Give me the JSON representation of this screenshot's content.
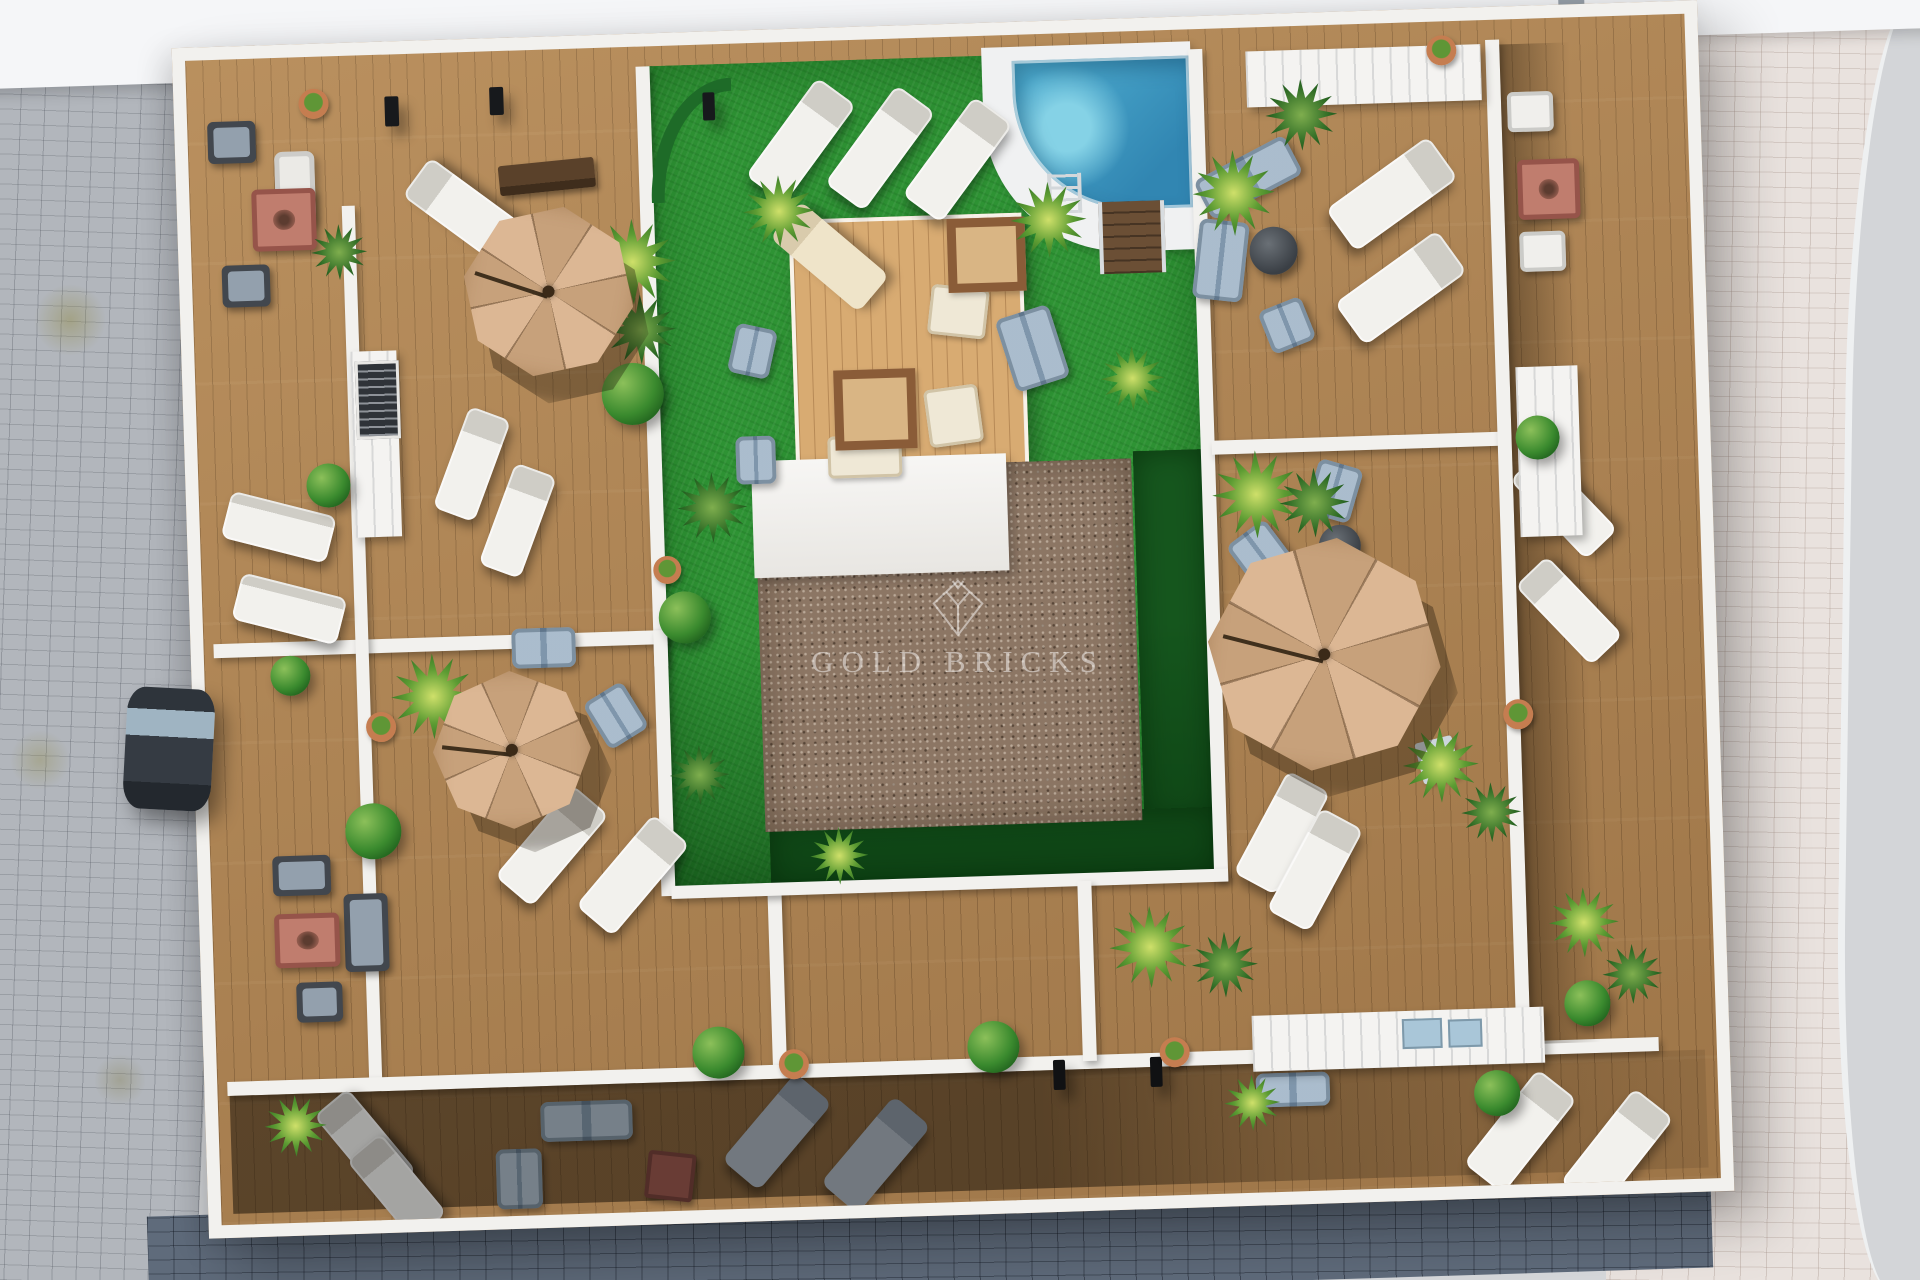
{
  "watermark": {
    "text": "GOLD BRICKS",
    "logo": "gold-bricks-diamond"
  },
  "palette": {
    "wall": "#f2f1ee",
    "wood": "#ae8352",
    "wood-line": "rgba(74,48,22,0.30)",
    "platform": "#d8ab72",
    "grass": "#2e9334",
    "grass-dark": "#16571e",
    "gravel": "#8c7664",
    "pool1": "#52b2d4",
    "pool2": "#3186b2",
    "umb1": "#dcb794",
    "umb2": "#c7a17b",
    "pave-left": "#b2b6bc",
    "pave-right": "#e9e2de",
    "pave-far": "#d3d5d8",
    "pave-bottom": "#5f6b7b",
    "band": "#f5f6f8",
    "wm": "rgba(255,255,255,0.48)"
  },
  "scene": {
    "zones": [
      [
        "courtyard-grass",
        "grass",
        460,
        20,
        545,
        825
      ],
      [
        "grass-shadow-right",
        "grass-dark",
        935,
        420,
        70,
        372
      ],
      [
        "grass-shadow-bottom",
        "grass-dark",
        560,
        778,
        445,
        67
      ],
      [
        "grass-shade",
        "grass-shade",
        460,
        590,
        545,
        255
      ],
      [
        "pool-deck",
        "pool-surround",
        796,
        12,
        209,
        208
      ],
      [
        "swimming-pool",
        "pool",
        826,
        26,
        177,
        152
      ],
      [
        "pool-steps",
        "steps",
        908,
        170,
        58,
        72
      ],
      [
        "wood-platform",
        "platform",
        598,
        178,
        225,
        262
      ],
      [
        "core-roof-gravel",
        "gravel",
        556,
        427,
        377,
        362
      ],
      [
        "core-roof-white",
        "core-white",
        553,
        418,
        255,
        117
      ],
      [
        "dividing-wall",
        "wall",
        450,
        20,
        14,
        600
      ],
      [
        "dividing-wall",
        "wall",
        10,
        584,
        454,
        14
      ],
      [
        "dividing-wall",
        "wall",
        152,
        150,
        13,
        880
      ],
      [
        "dividing-wall",
        "wall",
        450,
        584,
        14,
        266
      ],
      [
        "dividing-wall",
        "wall",
        556,
        845,
        14,
        185
      ],
      [
        "dividing-wall",
        "wall",
        10,
        1022,
        1432,
        14
      ],
      [
        "dividing-wall",
        "wall",
        1003,
        20,
        14,
        832
      ],
      [
        "dividing-wall",
        "wall",
        1014,
        412,
        292,
        14
      ],
      [
        "dividing-wall",
        "wall",
        1300,
        20,
        14,
        1010
      ],
      [
        "dividing-wall",
        "wall",
        460,
        840,
        557,
        13
      ],
      [
        "dividing-wall",
        "wall",
        866,
        848,
        14,
        180
      ],
      [
        "strip-shadow",
        "lshade",
        1314,
        25,
        70,
        1000
      ],
      [
        "lower-terrace-shade",
        "shade",
        12,
        1036,
        1476,
        118
      ]
    ],
    "items": [
      [
        "sun-lounger",
        "uwhite",
        589,
        38,
        48,
        122,
        38
      ],
      [
        "sun-lounger",
        "uwhite",
        668,
        48,
        48,
        122,
        38
      ],
      [
        "sun-lounger",
        "uwhite",
        745,
        62,
        48,
        122,
        38
      ],
      [
        "sun-lounger",
        "uwhite",
        250,
        100,
        48,
        118,
        -52
      ],
      [
        "sun-lounger",
        "uwhite",
        25,
        445,
        108,
        48,
        16
      ],
      [
        "sun-lounger",
        "uwhite",
        33,
        527,
        108,
        48,
        16
      ],
      [
        "sun-lounger",
        "uwhite",
        252,
        358,
        44,
        108,
        22
      ],
      [
        "sun-lounger",
        "uwhite",
        296,
        416,
        44,
        108,
        22
      ],
      [
        "sun-lounger",
        "uwhite",
        318,
        736,
        48,
        120,
        42
      ],
      [
        "sun-lounger",
        "uwhite",
        398,
        768,
        48,
        120,
        42
      ],
      [
        "sun-lounger",
        "uwhite",
        1176,
        108,
        52,
        126,
        56
      ],
      [
        "sun-lounger",
        "uwhite",
        1182,
        202,
        52,
        126,
        56
      ],
      [
        "sun-lounger",
        "uwhite",
        1048,
        748,
        48,
        116,
        30
      ],
      [
        "sun-lounger",
        "uwhite",
        1080,
        786,
        48,
        116,
        30
      ],
      [
        "sun-lounger",
        "uwhite",
        1342,
        432,
        44,
        110,
        -42
      ],
      [
        "sun-lounger",
        "uwhite",
        1344,
        538,
        44,
        110,
        -42
      ],
      [
        "sun-lounger",
        "uwhite",
        1276,
        1052,
        50,
        120,
        40
      ],
      [
        "sun-lounger",
        "uwhite",
        1372,
        1074,
        50,
        120,
        40
      ],
      [
        "sun-lounger",
        "uwhite",
        124,
        1034,
        44,
        108,
        -38
      ],
      [
        "sun-lounger",
        "uwhite",
        154,
        1080,
        44,
        104,
        -38
      ],
      [
        "sun-lounger",
        "ucream",
        614,
        158,
        48,
        116,
        -48
      ],
      [
        "sun-lounger",
        "ugray",
        534,
        1032,
        48,
        114,
        42
      ],
      [
        "sun-lounger",
        "ugray",
        632,
        1058,
        48,
        114,
        42
      ],
      [
        "seat-cushion",
        "cush",
        736,
        250,
        58,
        50,
        8
      ],
      [
        "seat-cushion",
        "cush",
        730,
        350,
        54,
        58,
        -6
      ],
      [
        "seat-cushion",
        "cush",
        630,
        396,
        74,
        42,
        0
      ],
      [
        "platform-tile",
        "tile",
        756,
        182,
        60,
        56,
        0
      ],
      [
        "platform-tile",
        "tile",
        638,
        330,
        64,
        62,
        0
      ],
      [
        "sofa",
        "bsofa",
        1008,
        128,
        102,
        44,
        -26
      ],
      [
        "sofa",
        "bsofa",
        1004,
        192,
        50,
        80,
        8
      ],
      [
        "armchair",
        "bsofa",
        1070,
        276,
        46,
        46,
        -20
      ],
      [
        "sofa",
        "bsofa",
        810,
        276,
        56,
        76,
        -16
      ],
      [
        "armchair",
        "bsofa",
        537,
        283,
        42,
        50,
        14
      ],
      [
        "armchair",
        "bsofa",
        538,
        393,
        40,
        48,
        0
      ],
      [
        "sofa",
        "bsofa",
        308,
        578,
        64,
        40,
        0
      ],
      [
        "armchair",
        "bsofa",
        387,
        641,
        46,
        54,
        -30
      ],
      [
        "armchair",
        "bsofa",
        1036,
        500,
        48,
        55,
        -35
      ],
      [
        "sofa",
        "bsofa",
        1112,
        438,
        46,
        56,
        18
      ],
      [
        "sofa",
        "bsofa",
        322,
        1052,
        92,
        40,
        0
      ],
      [
        "sofa",
        "bsofa",
        276,
        1098,
        46,
        60,
        0
      ],
      [
        "sofa",
        "bsofa",
        1038,
        1046,
        74,
        34,
        0
      ],
      [
        "sofa",
        "wsofa",
        86,
        94,
        40,
        74,
        0
      ],
      [
        "armchair",
        "wchair",
        1320,
        73,
        46,
        40,
        0
      ],
      [
        "armchair",
        "wchair",
        1328,
        213,
        46,
        40,
        0
      ],
      [
        "side-table",
        "cube",
        1211,
        717,
        38,
        42,
        -12
      ],
      [
        "armchair",
        "dchair",
        20,
        62,
        48,
        42,
        0
      ],
      [
        "armchair",
        "dchair",
        30,
        206,
        48,
        42,
        0
      ],
      [
        "armchair",
        "dchair",
        62,
        798,
        58,
        40,
        0
      ],
      [
        "armchair",
        "dchair",
        82,
        925,
        46,
        40,
        0
      ],
      [
        "sofa",
        "dchair",
        132,
        838,
        44,
        78,
        0
      ],
      [
        "fire-table",
        "fire",
        62,
        131,
        54,
        52,
        0
      ],
      [
        "fire-table",
        "fire",
        62,
        856,
        55,
        44,
        0
      ],
      [
        "fire-table",
        "fire",
        1328,
        141,
        52,
        50,
        0
      ],
      [
        "table",
        "redtbl",
        426,
        1106,
        40,
        40,
        8
      ],
      [
        "round-table",
        "rtable",
        1058,
        200,
        48,
        48,
        0
      ],
      [
        "round-table",
        "rtable",
        1118,
        500,
        42,
        42,
        0
      ],
      [
        "bench",
        "bench",
        310,
        112,
        96,
        30,
        -4
      ],
      [
        "kitchen-counter",
        "counter",
        156,
        296,
        46,
        186,
        0
      ],
      [
        "bbq-grill",
        "grill",
        160,
        306,
        38,
        72,
        0
      ],
      [
        "pool-equipment",
        "counter",
        1060,
        24,
        235,
        56,
        0
      ],
      [
        "kitchen-counter",
        "counter",
        1036,
        988,
        292,
        56,
        0
      ],
      [
        "sink",
        "sink",
        1186,
        996,
        36,
        26,
        0
      ],
      [
        "sink",
        "sink",
        1232,
        998,
        30,
        24,
        0
      ],
      [
        "kitchen-counter",
        "counter",
        1320,
        348,
        62,
        170,
        0
      ],
      [
        "pool-ladder",
        "ladder",
        858,
        140,
        26,
        40,
        0
      ],
      [
        "hedge-arc",
        "hedge",
        462,
        34,
        70,
        110,
        0
      ],
      [
        "wall-lamp",
        "lamp",
        198,
        42,
        14,
        30,
        0
      ],
      [
        "wall-lamp",
        "lamp",
        303,
        36,
        14,
        28,
        0
      ],
      [
        "wall-lamp",
        "lamp",
        516,
        48,
        12,
        28,
        0
      ],
      [
        "wall-lamp",
        "lamp",
        836,
        1026,
        12,
        30,
        0
      ],
      [
        "wall-lamp",
        "lamp",
        933,
        1026,
        12,
        30,
        0
      ],
      [
        "flower-pot",
        "pot",
        112,
        32,
        30,
        30,
        0
      ],
      [
        "flower-pot",
        "pot",
        160,
        657,
        30,
        30,
        0
      ],
      [
        "flower-pot",
        "pot",
        452,
        510,
        28,
        28,
        0
      ],
      [
        "flower-pot",
        "pot",
        562,
        1007,
        30,
        30,
        0
      ],
      [
        "flower-pot",
        "pot",
        943,
        1007,
        30,
        30,
        0
      ],
      [
        "flower-pot",
        "pot",
        1241,
        14,
        30,
        30,
        0
      ],
      [
        "flower-pot",
        "pot",
        1297,
        680,
        30,
        30,
        0
      ],
      [
        "bush",
        "bush",
        406,
        316,
        62,
        62,
        0
      ],
      [
        "bush",
        "bush",
        456,
        546,
        52,
        52,
        0
      ],
      [
        "bush",
        "bush",
        136,
        748,
        56,
        56,
        0
      ],
      [
        "bush",
        "bush",
        476,
        982,
        52,
        52,
        0
      ],
      [
        "bush",
        "bush",
        751,
        985,
        52,
        52,
        0
      ],
      [
        "bush",
        "bush",
        1349,
        963,
        46,
        46,
        0
      ],
      [
        "bush",
        "bush",
        1256,
        1050,
        46,
        46,
        0
      ],
      [
        "bush",
        "bush",
        108,
        407,
        44,
        44,
        0
      ],
      [
        "bush",
        "bush",
        1318,
        397,
        44,
        44,
        0
      ],
      [
        "bush",
        "bush",
        66,
        598,
        40,
        40,
        0
      ],
      [
        "plant",
        "palm",
        398,
        172,
        86,
        86,
        0
      ],
      [
        "plant",
        "trop",
        412,
        248,
        70,
        70,
        0
      ],
      [
        "plant",
        "palm",
        553,
        133,
        72,
        72,
        0
      ],
      [
        "plant",
        "palm",
        820,
        148,
        76,
        76,
        0
      ],
      [
        "plant",
        "trop",
        478,
        428,
        70,
        70,
        0
      ],
      [
        "plant",
        "palm",
        1003,
        122,
        82,
        86,
        0
      ],
      [
        "plant",
        "trop",
        1078,
        53,
        72,
        72,
        0
      ],
      [
        "plant",
        "palm",
        1013,
        423,
        88,
        88,
        0
      ],
      [
        "plant",
        "trop",
        1080,
        442,
        70,
        70,
        0
      ],
      [
        "plant",
        "palm",
        896,
        875,
        82,
        82,
        0
      ],
      [
        "plant",
        "trop",
        978,
        903,
        66,
        66,
        0
      ],
      [
        "plant",
        "palm",
        186,
        600,
        84,
        86,
        0
      ],
      [
        "plant",
        "palm",
        1195,
        705,
        76,
        76,
        0
      ],
      [
        "plant",
        "trop",
        1252,
        762,
        60,
        60,
        0
      ],
      [
        "plant",
        "palm",
        1336,
        870,
        70,
        70,
        0
      ],
      [
        "plant",
        "trop",
        1388,
        928,
        60,
        60,
        0
      ],
      [
        "plant",
        "palm",
        46,
        1037,
        62,
        62,
        0
      ],
      [
        "plant",
        "palm",
        1006,
        1047,
        56,
        56,
        0
      ],
      [
        "plant",
        "trop",
        462,
        700,
        60,
        60,
        0
      ],
      [
        "plant",
        "palm",
        600,
        786,
        58,
        58,
        0
      ],
      [
        "plant",
        "palm",
        905,
        315,
        64,
        64,
        0
      ],
      [
        "plant",
        "trop",
        120,
        168,
        56,
        56,
        0
      ]
    ],
    "umbrellas": [
      [
        "parasol",
        356,
        242,
        86,
        12
      ],
      [
        "parasol",
        305,
        699,
        79,
        0
      ],
      [
        "parasol",
        1120,
        629,
        117,
        8
      ]
    ],
    "street_items": [
      [
        "parked-car",
        "car",
        125,
        688,
        88,
        122,
        3
      ]
    ]
  }
}
